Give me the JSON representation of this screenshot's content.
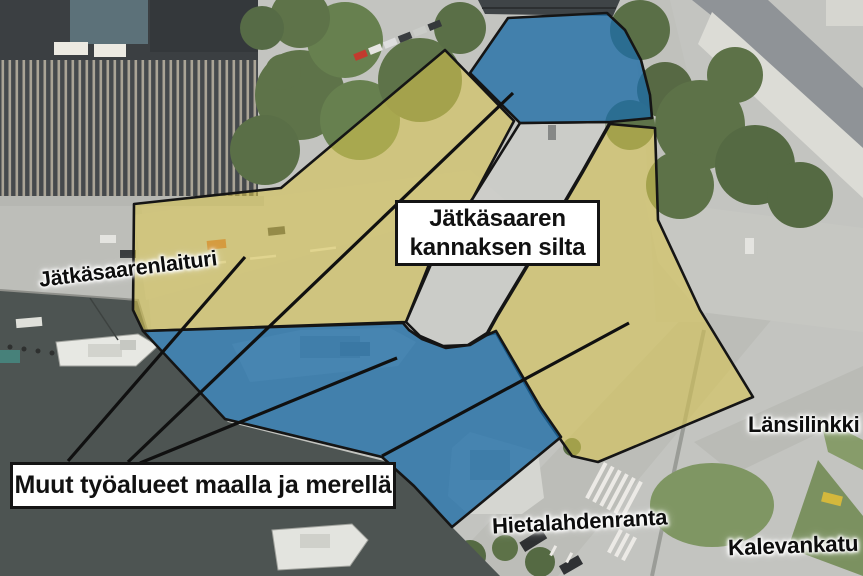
{
  "map": {
    "street_labels": {
      "jatkasaarenlaituri": "Jätkäsaarenlaituri",
      "lansilinkki": "Länsilinkki",
      "hietalahdenranta": "Hietalahdenranta",
      "kalevankatu": "Kalevankatu"
    },
    "callouts": {
      "silta_line1": "Jätkäsaaren",
      "silta_line2": "kannaksen silta",
      "muut": "Muut työalueet maalla ja merellä"
    },
    "colors": {
      "work_area_land": "#d7c44f",
      "work_area_sea": "#1d6da7",
      "bridge_area": "#d2d3cf",
      "leader_line": "#101010",
      "callout_bg": "#ffffff",
      "callout_border": "#141414"
    }
  }
}
